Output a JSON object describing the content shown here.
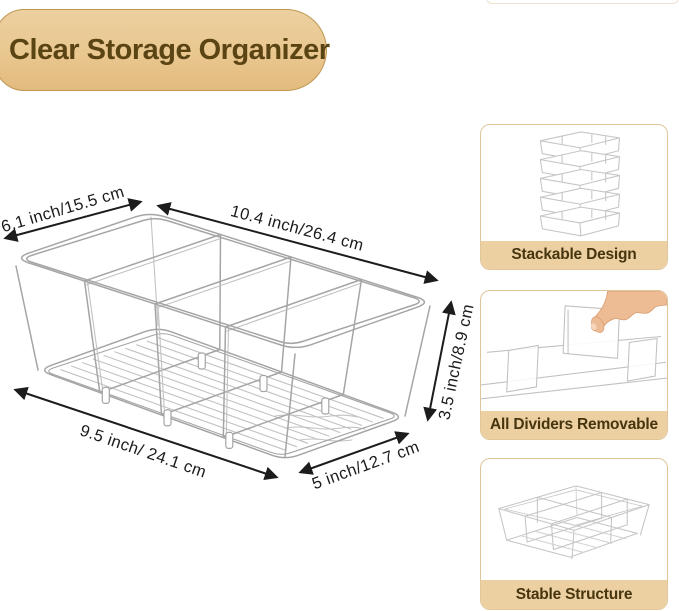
{
  "title": "Clear Storage Organizer",
  "product_diagram": {
    "description": "line drawing of clear 4-compartment storage bin with 3 dividers and ribbed bottom",
    "dimensions": {
      "top_width": "6.1 inch/15.5 cm",
      "top_length": "10.4 inch/26.4 cm",
      "bottom_length": "9.5 inch/ 24.1 cm",
      "bottom_width": "5 inch/12.7 cm",
      "height": "3.5 inch/8.9 cm"
    }
  },
  "features": [
    {
      "label": "Stackable Design",
      "illustration": "stacked-bins-line-art"
    },
    {
      "label": "All Dividers Removable",
      "illustration": "hand-removing-divider-photo"
    },
    {
      "label": "Stable Structure",
      "illustration": "divided-bin-line-art"
    }
  ],
  "colors": {
    "banner_fill": "#e9c78f",
    "banner_border": "#bf9551",
    "banner_text": "#5b4414",
    "feature_strip_fill": "#ecd0a2",
    "feature_card_border": "#dfc69b",
    "feature_text": "#47350f",
    "dimension_text": "#1b1b1b",
    "line_art": "#a5a5a5",
    "hand_skin": "#edbb94"
  }
}
